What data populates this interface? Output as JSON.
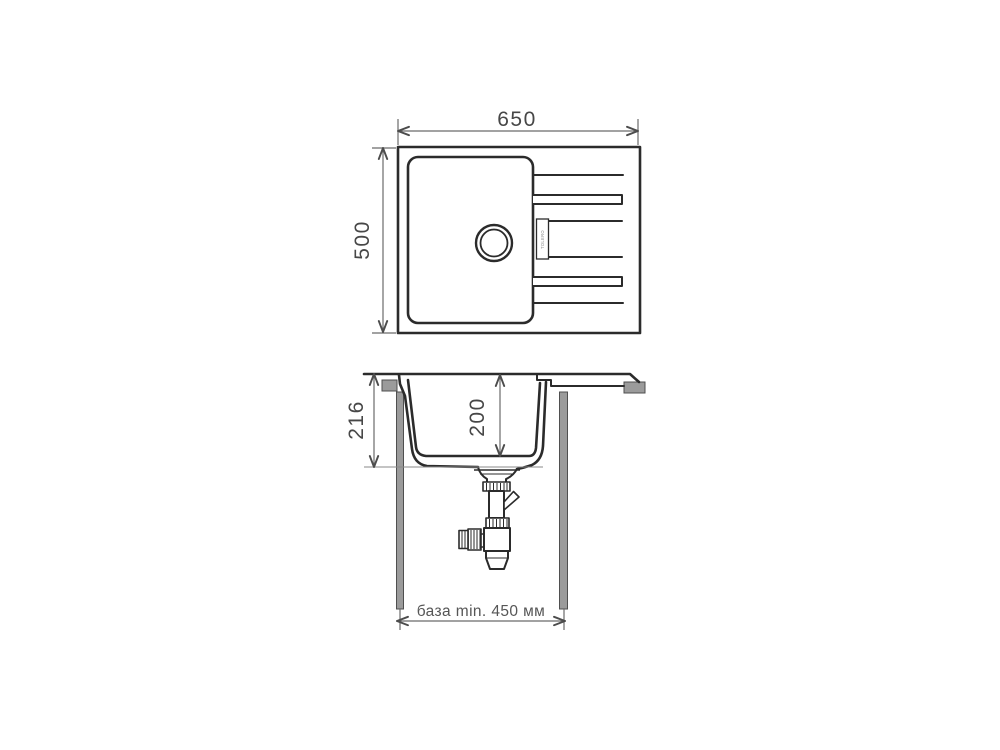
{
  "top_view": {
    "width_mm": "650",
    "depth_mm": "500",
    "brand": "TOLERO"
  },
  "section_view": {
    "total_height_mm": "216",
    "bowl_depth_mm": "200",
    "base_note": "база min. 450 мм"
  },
  "colors": {
    "outline": "#2b2b2b",
    "dimension_line": "#6b6b6b",
    "dimension_text": "#474747",
    "cabinet_gray": "#9b9b9b",
    "background": "#ffffff"
  }
}
